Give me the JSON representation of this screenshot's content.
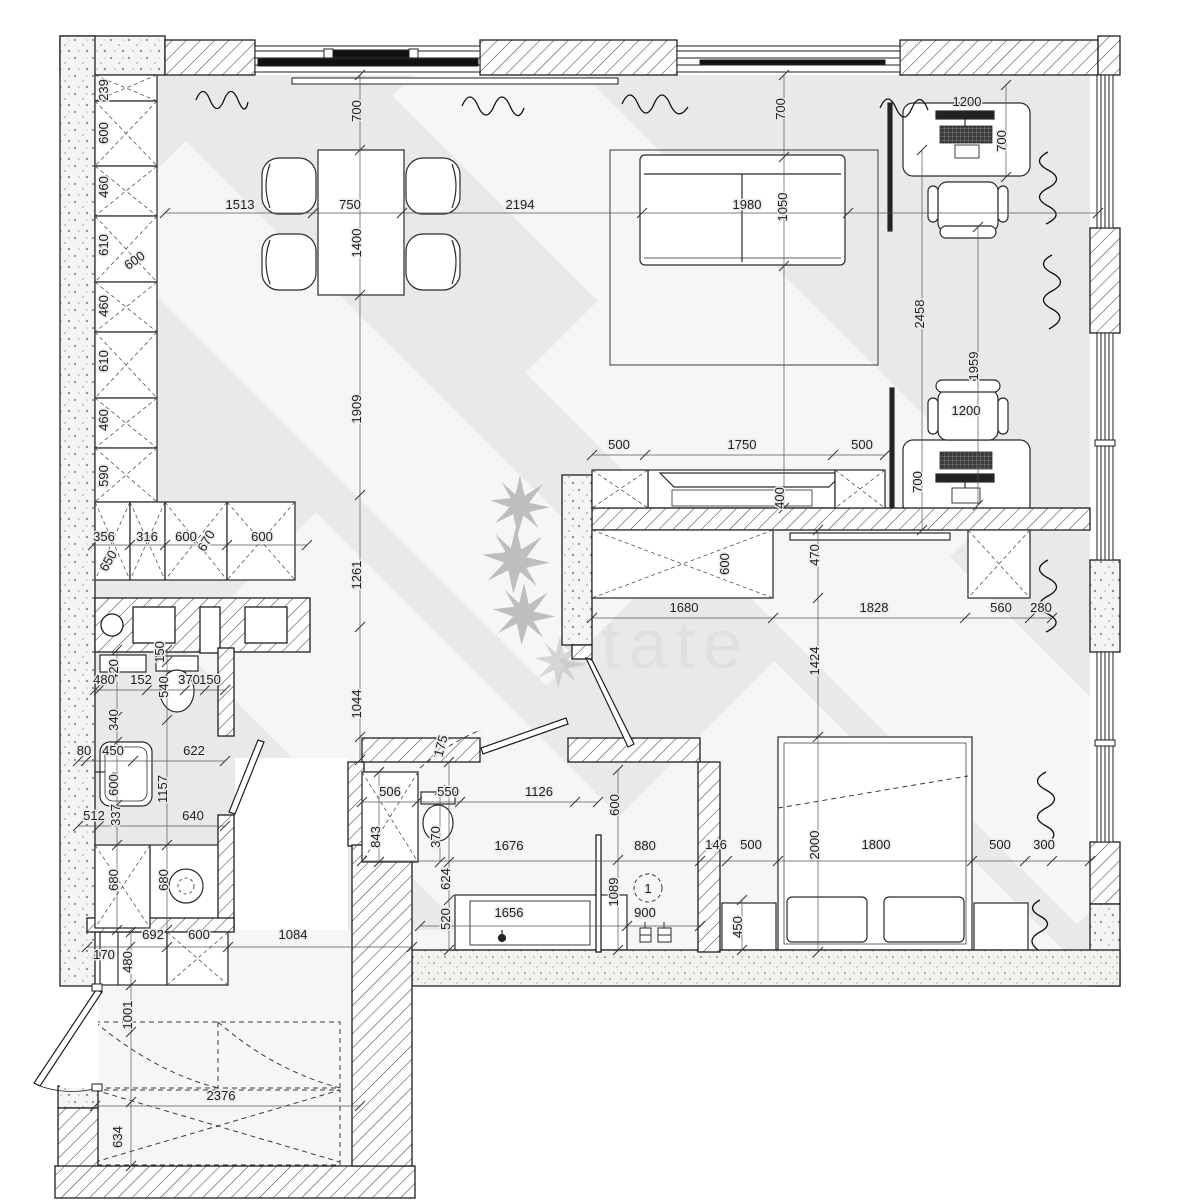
{
  "watermark": {
    "text": "state"
  },
  "colors": {
    "line": "#1f1f1f",
    "floor": "#e9e9e9",
    "wall_fill": "#ffffff",
    "dim_text": "#1f1f1f",
    "watermark_text": "#dfdfdf",
    "dark_bar": "#111111"
  },
  "door_tag": {
    "text": "1"
  },
  "dimension_labels": [
    {
      "text": "239",
      "x": 108,
      "y": 90,
      "rot": -90
    },
    {
      "text": "600",
      "x": 108,
      "y": 133,
      "rot": -90
    },
    {
      "text": "460",
      "x": 108,
      "y": 187,
      "rot": -90
    },
    {
      "text": "610",
      "x": 108,
      "y": 245,
      "rot": -90
    },
    {
      "text": "600",
      "x": 137,
      "y": 264,
      "rot": -35
    },
    {
      "text": "460",
      "x": 108,
      "y": 306,
      "rot": -90
    },
    {
      "text": "610",
      "x": 108,
      "y": 361,
      "rot": -90
    },
    {
      "text": "460",
      "x": 108,
      "y": 420,
      "rot": -90
    },
    {
      "text": "590",
      "x": 108,
      "y": 476,
      "rot": -90
    },
    {
      "text": "356",
      "x": 104,
      "y": 541,
      "rot": 0
    },
    {
      "text": "650",
      "x": 112,
      "y": 563,
      "rot": -60
    },
    {
      "text": "316",
      "x": 147,
      "y": 541,
      "rot": 0
    },
    {
      "text": "600",
      "x": 186,
      "y": 541,
      "rot": 0
    },
    {
      "text": "670",
      "x": 210,
      "y": 543,
      "rot": -60
    },
    {
      "text": "600",
      "x": 262,
      "y": 541,
      "rot": 0
    },
    {
      "text": "1513",
      "x": 240,
      "y": 209,
      "rot": 0
    },
    {
      "text": "750",
      "x": 350,
      "y": 209,
      "rot": 0
    },
    {
      "text": "2194",
      "x": 520,
      "y": 209,
      "rot": 0
    },
    {
      "text": "1980",
      "x": 747,
      "y": 209,
      "rot": 0
    },
    {
      "text": "1050",
      "x": 787,
      "y": 207,
      "rot": -90
    },
    {
      "text": "1400",
      "x": 361,
      "y": 243,
      "rot": -90
    },
    {
      "text": "700",
      "x": 361,
      "y": 111,
      "rot": -90
    },
    {
      "text": "700",
      "x": 785,
      "y": 109,
      "rot": -90
    },
    {
      "text": "1200",
      "x": 967,
      "y": 106,
      "rot": 0
    },
    {
      "text": "700",
      "x": 1006,
      "y": 141,
      "rot": -90
    },
    {
      "text": "2458",
      "x": 924,
      "y": 314,
      "rot": -90
    },
    {
      "text": "1959",
      "x": 978,
      "y": 366,
      "rot": -90
    },
    {
      "text": "1200",
      "x": 966,
      "y": 415,
      "rot": 0
    },
    {
      "text": "700",
      "x": 922,
      "y": 482,
      "rot": -90
    },
    {
      "text": "500",
      "x": 619,
      "y": 449,
      "rot": 0
    },
    {
      "text": "1750",
      "x": 742,
      "y": 449,
      "rot": 0
    },
    {
      "text": "500",
      "x": 862,
      "y": 449,
      "rot": 0
    },
    {
      "text": "400",
      "x": 784,
      "y": 498,
      "rot": -90
    },
    {
      "text": "600",
      "x": 729,
      "y": 564,
      "rot": -90
    },
    {
      "text": "470",
      "x": 819,
      "y": 555,
      "rot": -90
    },
    {
      "text": "1680",
      "x": 684,
      "y": 612,
      "rot": 0
    },
    {
      "text": "1828",
      "x": 874,
      "y": 612,
      "rot": 0
    },
    {
      "text": "560",
      "x": 1001,
      "y": 612,
      "rot": 0
    },
    {
      "text": "280",
      "x": 1041,
      "y": 612,
      "rot": 0
    },
    {
      "text": "1909",
      "x": 361,
      "y": 409,
      "rot": -90
    },
    {
      "text": "1261",
      "x": 361,
      "y": 575,
      "rot": -90
    },
    {
      "text": "1044",
      "x": 361,
      "y": 704,
      "rot": -90
    },
    {
      "text": "146",
      "x": 716,
      "y": 849,
      "rot": 0
    },
    {
      "text": "500",
      "x": 751,
      "y": 849,
      "rot": 0
    },
    {
      "text": "1800",
      "x": 876,
      "y": 849,
      "rot": 0
    },
    {
      "text": "500",
      "x": 1000,
      "y": 849,
      "rot": 0
    },
    {
      "text": "300",
      "x": 1044,
      "y": 849,
      "rot": 0
    },
    {
      "text": "2000",
      "x": 819,
      "y": 845,
      "rot": -90
    },
    {
      "text": "1424",
      "x": 819,
      "y": 661,
      "rot": -90
    },
    {
      "text": "450",
      "x": 742,
      "y": 927,
      "rot": -90
    },
    {
      "text": "420",
      "x": 118,
      "y": 670,
      "rot": -90
    },
    {
      "text": "150",
      "x": 164,
      "y": 652,
      "rot": -90
    },
    {
      "text": "480",
      "x": 104,
      "y": 684,
      "rot": 0
    },
    {
      "text": "152",
      "x": 141,
      "y": 684,
      "rot": 0
    },
    {
      "text": "540",
      "x": 168,
      "y": 687,
      "rot": -90
    },
    {
      "text": "370",
      "x": 189,
      "y": 684,
      "rot": 0
    },
    {
      "text": "150",
      "x": 210,
      "y": 684,
      "rot": 0
    },
    {
      "text": "340",
      "x": 118,
      "y": 720,
      "rot": -90
    },
    {
      "text": "80",
      "x": 84,
      "y": 755,
      "rot": 0
    },
    {
      "text": "450",
      "x": 113,
      "y": 755,
      "rot": 0
    },
    {
      "text": "600",
      "x": 118,
      "y": 785,
      "rot": -90
    },
    {
      "text": "622",
      "x": 194,
      "y": 755,
      "rot": 0
    },
    {
      "text": "1157",
      "x": 167,
      "y": 789,
      "rot": -90
    },
    {
      "text": "337",
      "x": 120,
      "y": 815,
      "rot": -90
    },
    {
      "text": "512",
      "x": 94,
      "y": 820,
      "rot": 0
    },
    {
      "text": "640",
      "x": 193,
      "y": 820,
      "rot": 0
    },
    {
      "text": "680",
      "x": 118,
      "y": 880,
      "rot": -90
    },
    {
      "text": "680",
      "x": 168,
      "y": 880,
      "rot": -90
    },
    {
      "text": "692",
      "x": 153,
      "y": 939,
      "rot": 0
    },
    {
      "text": "600",
      "x": 199,
      "y": 939,
      "rot": 0
    },
    {
      "text": "1084",
      "x": 293,
      "y": 939,
      "rot": 0
    },
    {
      "text": "170",
      "x": 104,
      "y": 959,
      "rot": 0
    },
    {
      "text": "480",
      "x": 132,
      "y": 962,
      "rot": -90
    },
    {
      "text": "1001",
      "x": 132,
      "y": 1015,
      "rot": -90
    },
    {
      "text": "2376",
      "x": 221,
      "y": 1100,
      "rot": 0
    },
    {
      "text": "634",
      "x": 122,
      "y": 1137,
      "rot": -90
    },
    {
      "text": "175",
      "x": 445,
      "y": 747,
      "rot": -75
    },
    {
      "text": "506",
      "x": 390,
      "y": 796,
      "rot": 0
    },
    {
      "text": "550",
      "x": 448,
      "y": 796,
      "rot": 0
    },
    {
      "text": "1126",
      "x": 539,
      "y": 796,
      "rot": 0
    },
    {
      "text": "843",
      "x": 380,
      "y": 837,
      "rot": -90
    },
    {
      "text": "370",
      "x": 440,
      "y": 837,
      "rot": -90
    },
    {
      "text": "1676",
      "x": 509,
      "y": 850,
      "rot": 0
    },
    {
      "text": "880",
      "x": 645,
      "y": 850,
      "rot": 0
    },
    {
      "text": "624",
      "x": 450,
      "y": 879,
      "rot": -90
    },
    {
      "text": "520",
      "x": 450,
      "y": 919,
      "rot": -90
    },
    {
      "text": "1656",
      "x": 509,
      "y": 917,
      "rot": 0
    },
    {
      "text": "1089",
      "x": 618,
      "y": 892,
      "rot": -90
    },
    {
      "text": "900",
      "x": 645,
      "y": 917,
      "rot": 0
    },
    {
      "text": "600",
      "x": 619,
      "y": 805,
      "rot": -90
    },
    {
      "text": "1",
      "x": 648,
      "y": 893,
      "rot": 0
    }
  ]
}
